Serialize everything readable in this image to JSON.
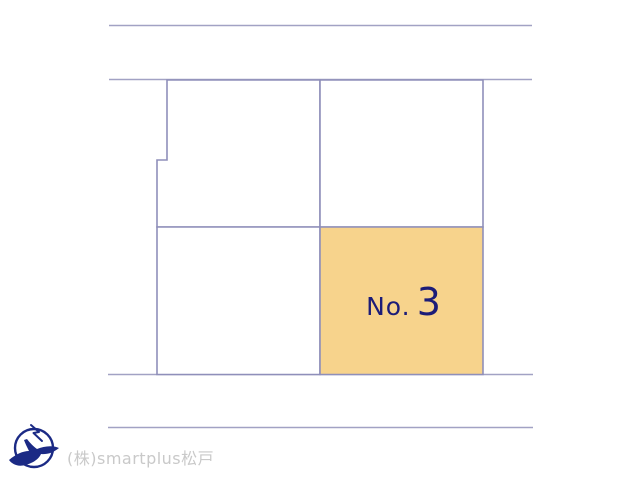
{
  "plot_map": {
    "line_color": "#a2a2c4",
    "parcel_border_color": "#8f8fba",
    "parcel_fill": "#ffffff",
    "highlight_plot": {
      "label_prefix": "No.",
      "label_number": "3",
      "fill_color": "#f7d38c",
      "label_color": "#1c1c78"
    }
  },
  "footer": {
    "company_name": "(株)smartplus松戸",
    "company_text_color": "#c9c9c9",
    "logo": {
      "icon": "bird-circle-logo",
      "color": "#1b2a85"
    }
  }
}
